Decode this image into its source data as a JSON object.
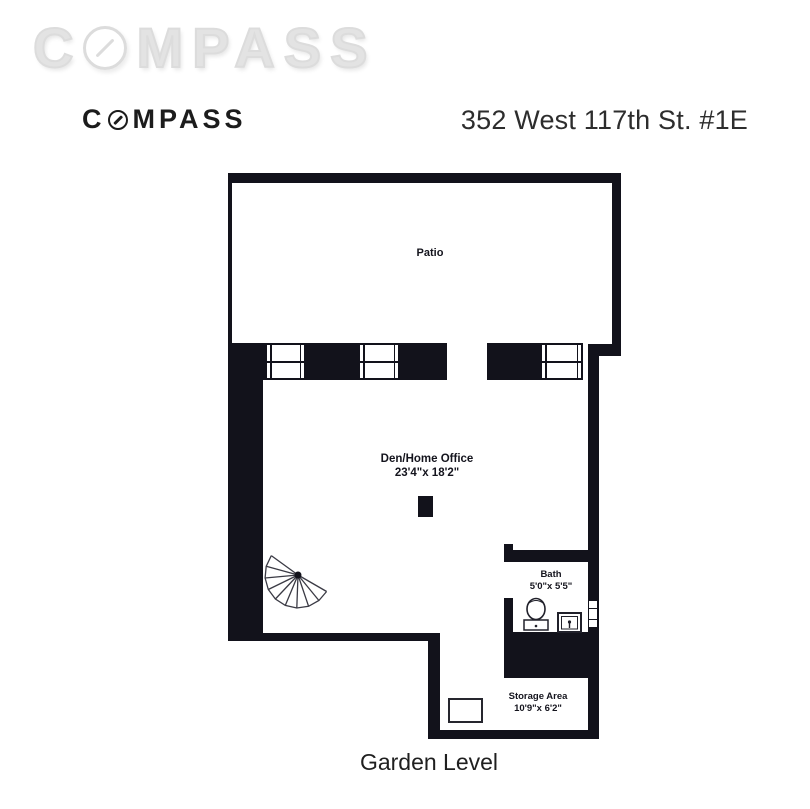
{
  "watermark": {
    "text_prefix": "C",
    "text_suffix": "MPASS"
  },
  "brand_logo": {
    "text_prefix": "C",
    "text_suffix": "MPASS"
  },
  "header": {
    "address": "352 West 117th St. #1E"
  },
  "floorplan": {
    "level": "Garden Level",
    "rooms": {
      "patio": {
        "name": "Patio"
      },
      "den": {
        "name": "Den/Home Office",
        "dims": "23'4\"x 18'2\""
      },
      "bath": {
        "name": "Bath",
        "dims": "5'0\"x 5'5\""
      },
      "storage": {
        "name": "Storage Area",
        "dims": "10'9\"x 6'2\""
      }
    }
  },
  "colors": {
    "wall": "#12121b",
    "watermark": "#e3e3e3",
    "logo": "#1c1c1c",
    "heading": "#2d2d2d",
    "label": "#14141d"
  }
}
